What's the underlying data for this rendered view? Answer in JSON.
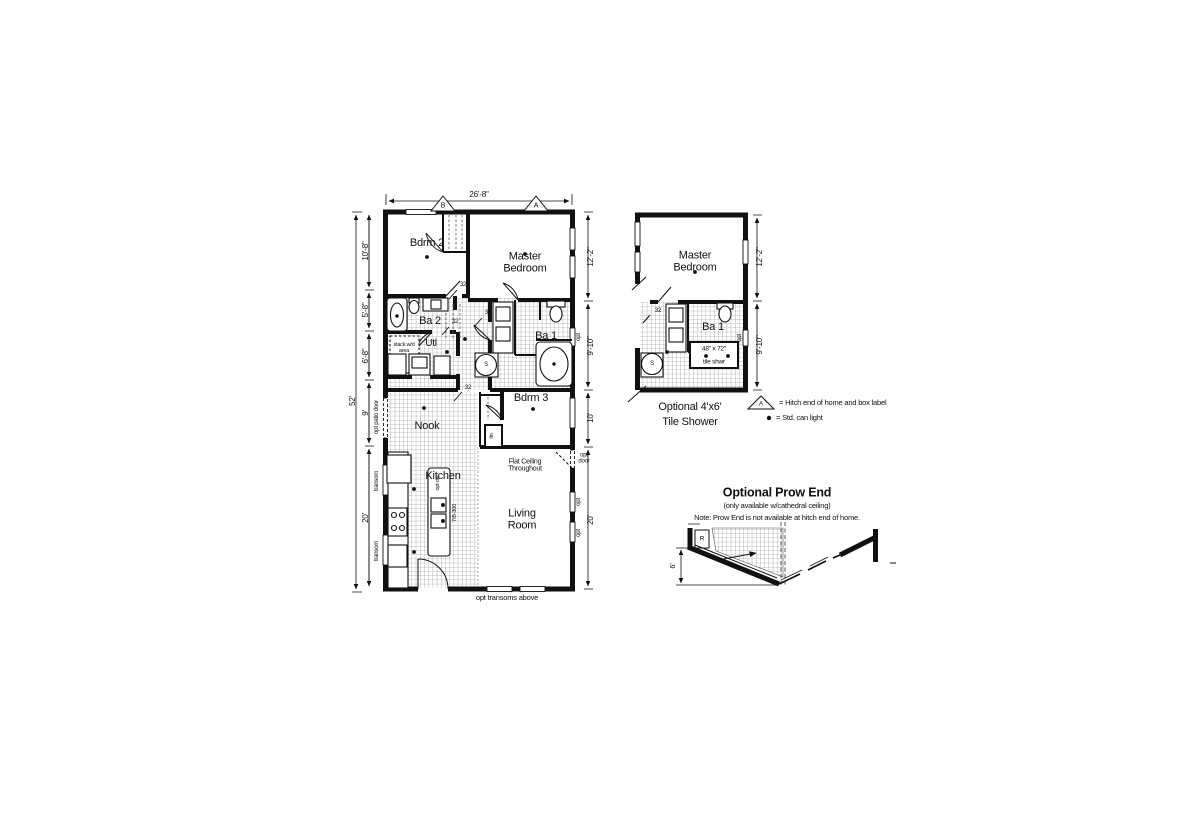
{
  "sheet": {
    "type": "manufactured-home floor plan"
  },
  "colors": {
    "wall": "#111111",
    "hatch": "#7d7d7d",
    "background": "#ffffff",
    "text": "#111111"
  },
  "main_plan": {
    "top_dim": "26'-8\"",
    "overall_dim": "52'",
    "marker_b": "B",
    "marker_a": "A",
    "left_dims": [
      "10'-8\"",
      "5'-8\"",
      "6'-8\"",
      "9'",
      "20'"
    ],
    "right_dims": [
      "12'-2\"",
      "9'-10\"",
      "10'",
      "20'"
    ],
    "rooms": {
      "bdrm2": "Bdrm 2",
      "master": "Master Bedroom",
      "ba2": "Ba 2",
      "utl": "Utl",
      "ba1": "Ba 1",
      "bdrm3": "Bdrm 3",
      "nook": "Nook",
      "kitchen": "Kitchen",
      "living": "Living Room"
    },
    "labels": {
      "stack_wd": "stack w/d area",
      "flat_ceiling": "Flat Ceiling Throughout",
      "opt_transoms": "opt transoms above",
      "door_size": "32",
      "opt": "opt",
      "opt_door": "opt door",
      "opt_patio_door": "opt patio door",
      "transom": "transom",
      "island_model": "7/B-300",
      "opt_dw": "opt dw",
      "linen": "lin",
      "shower": "S"
    }
  },
  "alt_plan": {
    "rooms": {
      "master": "Master Bedroom",
      "ba1": "Ba 1"
    },
    "labels": {
      "shower_size": "48\" x 72\"",
      "tile_shwr": "tile shwr",
      "door_size": "32",
      "opt": "opt",
      "shower": "S"
    },
    "right_dims": [
      "12'-2\"",
      "9'-10\""
    ],
    "caption_line1": "Optional 4'x6'",
    "caption_line2": "Tile Shower"
  },
  "legend": {
    "hitch_marker": "A",
    "hitch_text": "= Hitch end of home and box label",
    "can_light_text": "= Std. can light"
  },
  "prow": {
    "title": "Optional Prow End",
    "subtitle": "(only available w/cathedral ceiling)",
    "note": "Note: Prow End is not available at hitch end of home.",
    "dim": "6'",
    "r_label": "R"
  }
}
